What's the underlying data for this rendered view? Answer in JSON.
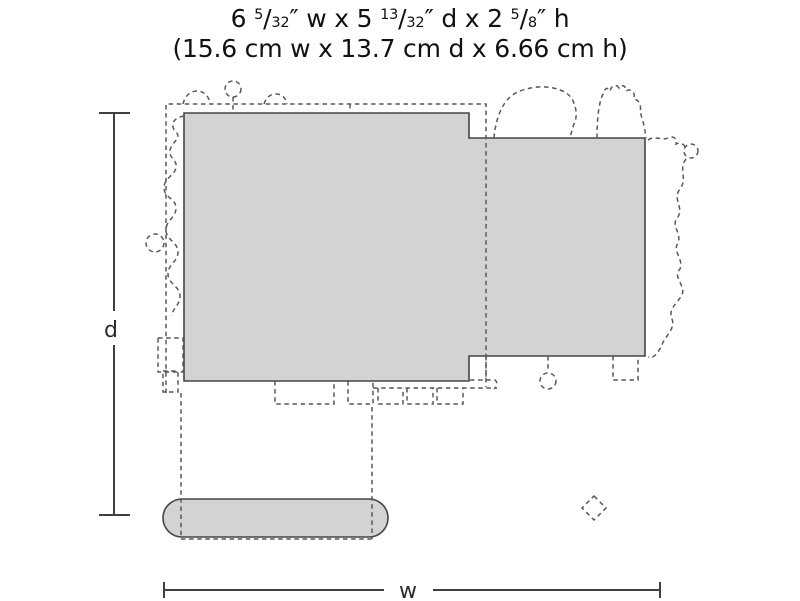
{
  "title": {
    "line1_parts": [
      "6 ",
      "5",
      "/",
      "32",
      "″ w x 5 ",
      "13",
      "/",
      "32",
      "″ d x 2 ",
      "5",
      "/",
      "8",
      "″ h"
    ],
    "line2": "(15.6 cm w x 13.7 cm d x 6.66 cm h)"
  },
  "diagram": {
    "depth_label": "d",
    "width_label": "w"
  },
  "colors": {
    "footprint_fill": "#d2d3d4",
    "solid_outline": "#454545",
    "dashed_outline": "#585858",
    "dimension_line": "#3f3f3f",
    "title_text": "#111111"
  }
}
